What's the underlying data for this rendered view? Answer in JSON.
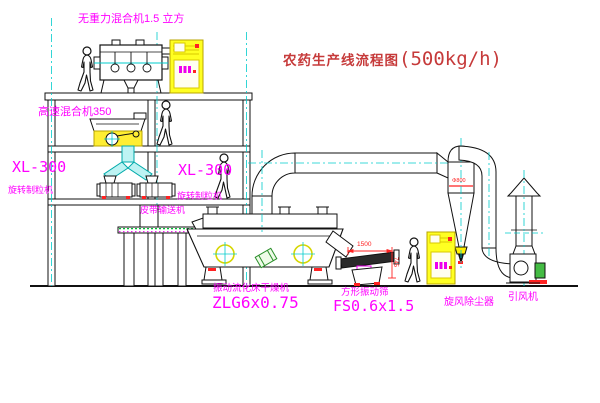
{
  "diagram": {
    "title": {
      "name": "农药生产线流程图",
      "capacity": "(500kg/h)"
    },
    "labels": {
      "gravity_mixer": "无重力混合机1.5 立方",
      "high_speed_mixer": "高速混合机350",
      "granulator_model_left": "XL-300",
      "granulator_name_left": "旋转制粒机",
      "granulator_model_right": "XL-300",
      "granulator_name_right": "旋转制粒机",
      "belt_conveyor": "皮带输送机",
      "dryer_name": "振动流化床干燥机",
      "dryer_model": "ZLG6x0.75",
      "screen_name": "方形振动筛",
      "screen_model": "FS0.6x1.5",
      "cyclone": "旋风除尘器",
      "fan": "引风机"
    },
    "dimensions": {
      "screen_length": "1500",
      "screen_height": "745",
      "cyclone_dia": "Φ800"
    },
    "colors": {
      "label_magenta": "#ff00ff",
      "title_red": "#c63a3a",
      "dimension_red": "#ff2222",
      "centerline_cyan": "#00cccc",
      "cabinet_yellow": "#ffff22",
      "motor_green": "#33aa33"
    }
  }
}
